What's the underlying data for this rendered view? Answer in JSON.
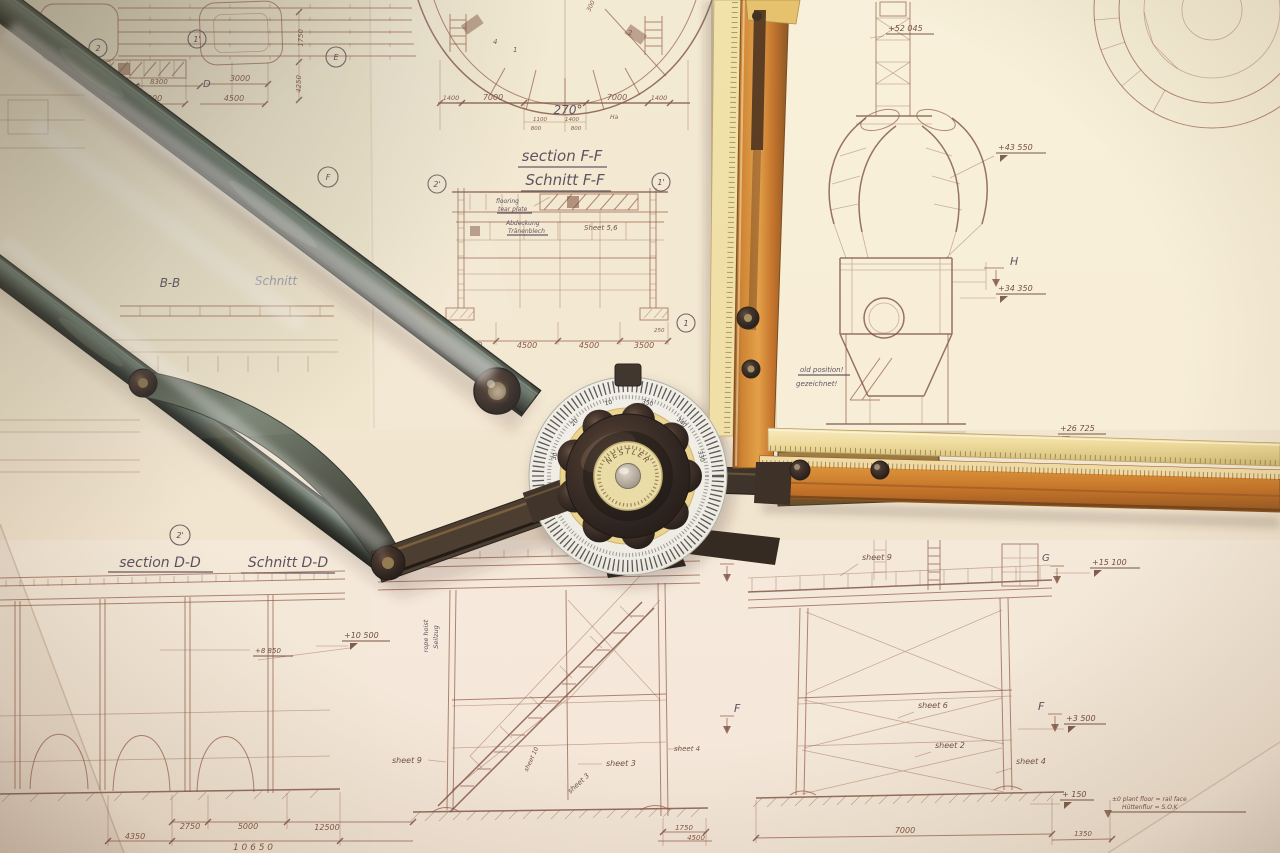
{
  "palette": {
    "paper": "#f1e8d1",
    "line_sepia": "#8a4f3c",
    "ink_dark": "#453a4f",
    "arm_patina": "#4f6054",
    "ruler_orange": "#c9731f",
    "ruler_yellow": "#eedc9a",
    "knob_black": "#221a14",
    "brass": "#8a6938",
    "protractor_white": "#eef0ea"
  },
  "instrument": {
    "brand": "NESTLER",
    "protractor_degrees": [
      "10",
      "20",
      "30",
      "350",
      "340",
      "330"
    ]
  },
  "titles": {
    "section_ff_en": "section F-F",
    "section_ff_de": "Schnitt F-F",
    "section_dd_en": "section D-D",
    "section_dd_de": "Schnitt D-D",
    "partial_b_b": "B-B",
    "partial_schnitt": "Schnitt"
  },
  "notes": {
    "angle": "270°",
    "ha": "Ha",
    "old_position_en": "old position!",
    "old_position_de": "gezeichnet!",
    "flooring_en_1": "flooring",
    "flooring_en_2": "tear plate",
    "cover_de_1": "Abdeckung",
    "cover_de_2": "Tränenblech",
    "rope_en": "rope hoist",
    "rope_de": "Seilzug",
    "plant_floor_en": "±0  plant floor = rail face",
    "plant_floor_de": "Hüttenflur = S.O.K"
  },
  "sheet_refs": {
    "s56": "Sheet 5,6",
    "s9_right": "sheet 9",
    "s6_right": "sheet 6",
    "s2_right": "sheet 2",
    "s4_right": "sheet 4",
    "s9_center": "sheet 9",
    "s10_center": "sheet 10",
    "s3_center_a": "sheet 3",
    "s3_center_b": "sheet 3",
    "s4_center": "sheet 4"
  },
  "elevations": {
    "e52045": "+52 045",
    "e43550": "+43 550",
    "e34350": "+34 350",
    "e26725": "+26 725",
    "e15100": "+15 100",
    "e10500": "+10 500",
    "e8850": "+8 850",
    "e3500": "+3 500",
    "e150": "+ 150"
  },
  "grid_markers": {
    "m2_tl": "2",
    "m1p_tl": "1'",
    "mE": "E",
    "mF": "F",
    "m2p_ff": "2'",
    "m1p_ff": "1'",
    "m2_ff": "2",
    "m1_ff": "1",
    "m2p_dd": "2'",
    "mC": "C",
    "mD": "D",
    "mH": "H",
    "mG_l": "G",
    "mG_r": "G",
    "mF_l": "F",
    "mF_r": "F",
    "m1_dome": "1",
    "m2_dome": "2",
    "m4_dome": "4"
  },
  "dimensions": {
    "d8300": "8300",
    "d3000": "3000",
    "d4500_tl": "4500",
    "d7000_tl": "7000",
    "d1750_v": "1750",
    "d4250_v": "4250",
    "d1400_l": "1400",
    "d7000_a": "7000",
    "d7000_b": "7000",
    "d1400_r": "1400",
    "d1100": "1100",
    "d1400_c": "1400",
    "d800_a": "800",
    "d800_b": "800",
    "d300_dome": "300",
    "d3500_a": "3500",
    "d4500_a": "4500",
    "d4500_b": "4500",
    "d3500_b": "3500",
    "d250_a": "250",
    "d250_b": "250",
    "d2750": "2750",
    "d5000": "5000",
    "d12500": "12500",
    "d4350": "4350",
    "d10650": "1 0 6 5 0",
    "d1750_c": "1750",
    "d4500_c": "4500",
    "d7000_br": "7000",
    "d1350_br": "1350"
  }
}
